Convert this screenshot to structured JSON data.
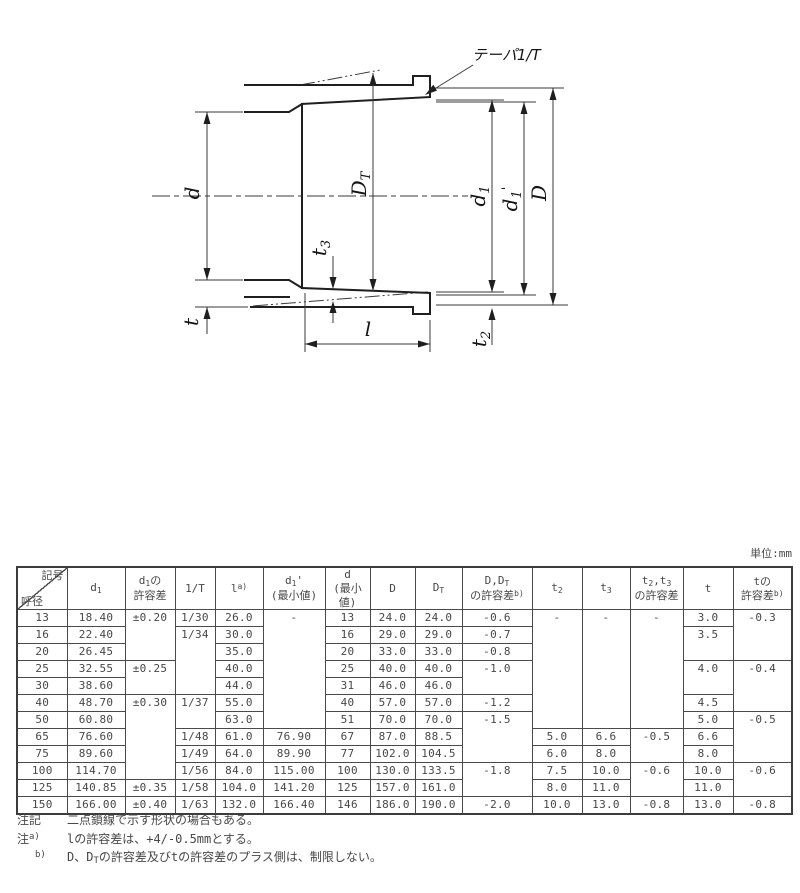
{
  "drawing": {
    "taper_label": "テーパ1/T",
    "labels": {
      "d": "d",
      "t": "t",
      "l": "l",
      "D": "D",
      "DT_base": "D",
      "DT_sub": "T",
      "d1_base": "d",
      "d1_sub": "1",
      "d1p_base": "d",
      "d1p_sub": "1",
      "d1p_prime": "'",
      "t2_base": "t",
      "t2_sub": "2",
      "t3_base": "t",
      "t3_sub": "3"
    }
  },
  "table": {
    "unit": "単位:mm",
    "header": {
      "corner_top": "記号",
      "corner_bottom": "呼径",
      "d1": {
        "base": "d",
        "sub": "1"
      },
      "d1_tol": {
        "l1_base": "d",
        "l1_sub": "1",
        "l1_tail": "の",
        "l2": "許容差"
      },
      "invT": "1/T",
      "l": {
        "base": "l",
        "sup": "a)"
      },
      "d1p": {
        "base": "d",
        "sub": "1",
        "prime": "'",
        "l2": "(最小値)"
      },
      "d_min": {
        "l1": "d",
        "l2": "(最小値)"
      },
      "D": "D",
      "DT": {
        "base": "D",
        "sub": "T"
      },
      "DDT_tol": {
        "l1_base": "D,D",
        "l1_sub": "T",
        "l2": "の許容差",
        "l2_sup": "b)"
      },
      "t2": {
        "base": "t",
        "sub": "2"
      },
      "t3": {
        "base": "t",
        "sub": "3"
      },
      "t2t3_tol": {
        "l1_a": "t",
        "l1_a_sub": "2",
        "l1_b": ",t",
        "l1_b_sub": "3",
        "l2": "の許容差"
      },
      "t": "t",
      "t_tol": {
        "l1": "tの",
        "l2": "許容差",
        "l2_sup": "b)"
      }
    },
    "body": [
      [
        {
          "v": "13"
        },
        {
          "v": "18.40"
        },
        {
          "v": "±0.20",
          "rs": 3
        },
        {
          "v": "1/30"
        },
        {
          "v": "26.0"
        },
        {
          "v": "-",
          "rs": 7
        },
        {
          "v": "13"
        },
        {
          "v": "24.0"
        },
        {
          "v": "24.0"
        },
        {
          "v": "-0.6"
        },
        {
          "v": "-",
          "rs": 7
        },
        {
          "v": "-",
          "rs": 7
        },
        {
          "v": "-",
          "rs": 7
        },
        {
          "v": "3.0"
        },
        {
          "v": "-0.3",
          "rs": 3
        }
      ],
      [
        {
          "v": "16"
        },
        {
          "v": "22.40"
        },
        {
          "v": "1/34",
          "rs": 4
        },
        {
          "v": "30.0"
        },
        {
          "v": "16"
        },
        {
          "v": "29.0"
        },
        {
          "v": "29.0"
        },
        {
          "v": "-0.7"
        },
        {
          "v": "3.5",
          "rs": 2
        }
      ],
      [
        {
          "v": "20"
        },
        {
          "v": "26.45"
        },
        {
          "v": "35.0"
        },
        {
          "v": "20"
        },
        {
          "v": "33.0"
        },
        {
          "v": "33.0"
        },
        {
          "v": "-0.8"
        }
      ],
      [
        {
          "v": "25"
        },
        {
          "v": "32.55"
        },
        {
          "v": "±0.25",
          "rs": 2
        },
        {
          "v": "40.0"
        },
        {
          "v": "25"
        },
        {
          "v": "40.0"
        },
        {
          "v": "40.0"
        },
        {
          "v": "-1.0",
          "rs": 2
        },
        {
          "v": "4.0",
          "rs": 2
        },
        {
          "v": "-0.4",
          "rs": 3
        }
      ],
      [
        {
          "v": "30"
        },
        {
          "v": "38.60"
        },
        {
          "v": "44.0"
        },
        {
          "v": "31"
        },
        {
          "v": "46.0"
        },
        {
          "v": "46.0"
        }
      ],
      [
        {
          "v": "40"
        },
        {
          "v": "48.70"
        },
        {
          "v": "±0.30",
          "rs": 5
        },
        {
          "v": "1/37",
          "rs": 2
        },
        {
          "v": "55.0"
        },
        {
          "v": "40"
        },
        {
          "v": "57.0"
        },
        {
          "v": "57.0"
        },
        {
          "v": "-1.2"
        },
        {
          "v": "4.5"
        }
      ],
      [
        {
          "v": "50"
        },
        {
          "v": "60.80"
        },
        {
          "v": "63.0"
        },
        {
          "v": "51"
        },
        {
          "v": "70.0"
        },
        {
          "v": "70.0"
        },
        {
          "v": "-1.5",
          "rs": 3
        },
        {
          "v": "5.0"
        },
        {
          "v": "-0.5",
          "rs": 3
        }
      ],
      [
        {
          "v": "65"
        },
        {
          "v": "76.60"
        },
        {
          "v": "1/48"
        },
        {
          "v": "61.0"
        },
        {
          "v": "76.90"
        },
        {
          "v": "67"
        },
        {
          "v": "87.0"
        },
        {
          "v": "88.5"
        },
        {
          "v": "5.0"
        },
        {
          "v": "6.6"
        },
        {
          "v": "-0.5",
          "rs": 2
        },
        {
          "v": "6.6"
        }
      ],
      [
        {
          "v": "75"
        },
        {
          "v": "89.60"
        },
        {
          "v": "1/49"
        },
        {
          "v": "64.0"
        },
        {
          "v": "89.90"
        },
        {
          "v": "77"
        },
        {
          "v": "102.0"
        },
        {
          "v": "104.5"
        },
        {
          "v": "6.0"
        },
        {
          "v": "8.0"
        },
        {
          "v": "8.0"
        }
      ],
      [
        {
          "v": "100"
        },
        {
          "v": "114.70"
        },
        {
          "v": "1/56"
        },
        {
          "v": "84.0"
        },
        {
          "v": "115.00"
        },
        {
          "v": "100"
        },
        {
          "v": "130.0"
        },
        {
          "v": "133.5"
        },
        {
          "v": "-1.8",
          "rs": 2
        },
        {
          "v": "7.5"
        },
        {
          "v": "10.0"
        },
        {
          "v": "-0.6",
          "rs": 2
        },
        {
          "v": "10.0"
        },
        {
          "v": "-0.6",
          "rs": 2
        }
      ],
      [
        {
          "v": "125"
        },
        {
          "v": "140.85"
        },
        {
          "v": "±0.35"
        },
        {
          "v": "1/58"
        },
        {
          "v": "104.0"
        },
        {
          "v": "141.20"
        },
        {
          "v": "125"
        },
        {
          "v": "157.0"
        },
        {
          "v": "161.0"
        },
        {
          "v": "8.0"
        },
        {
          "v": "11.0"
        },
        {
          "v": "11.0"
        }
      ],
      [
        {
          "v": "150"
        },
        {
          "v": "166.00"
        },
        {
          "v": "±0.40"
        },
        {
          "v": "1/63"
        },
        {
          "v": "132.0"
        },
        {
          "v": "166.40"
        },
        {
          "v": "146"
        },
        {
          "v": "186.0"
        },
        {
          "v": "190.0"
        },
        {
          "v": "-2.0"
        },
        {
          "v": "10.0"
        },
        {
          "v": "13.0"
        },
        {
          "v": "-0.8"
        },
        {
          "v": "13.0"
        },
        {
          "v": "-0.8"
        }
      ]
    ]
  },
  "notes": [
    {
      "label": "注記",
      "text": "二点鎖線で示す形状の場合もある。"
    },
    {
      "label": "注",
      "sup": "a)",
      "text": "lの許容差は、+4/-0.5mmとする。"
    },
    {
      "sup": "b)",
      "pre": "D、D",
      "sub": "T",
      "post": "の許容差及びtの許容差のプラス側は、制限しない。"
    }
  ]
}
